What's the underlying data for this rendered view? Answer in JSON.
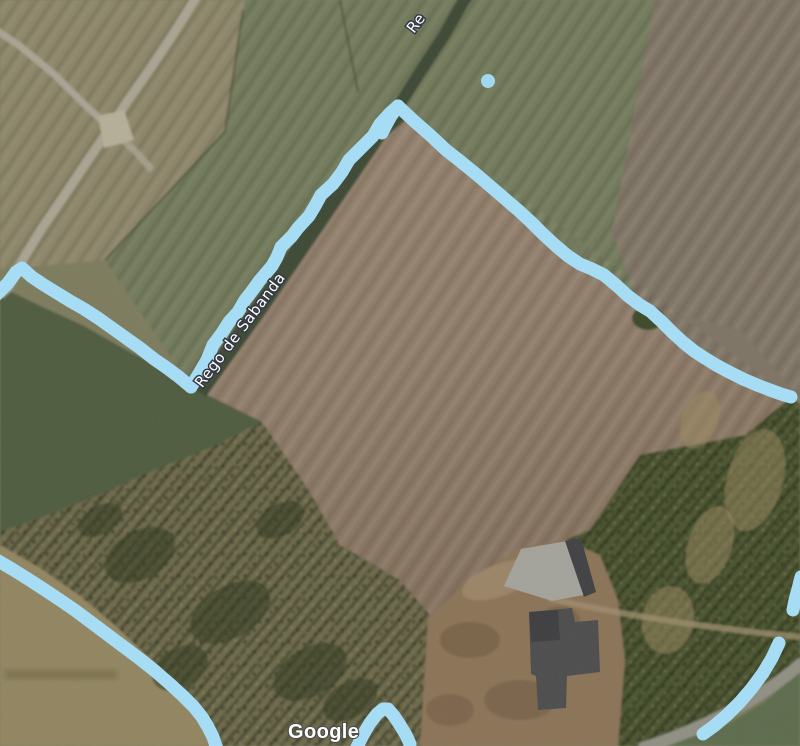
{
  "map": {
    "watermark": "Google",
    "labels": {
      "stream": "Rego de Sabanda",
      "stream_partial": "Re"
    },
    "annotation": {
      "stroke_color": "#a6dcf4",
      "stroke_width": 13,
      "dot_color": "#a0d8f0"
    },
    "terrain_colors": {
      "plowed_field": "#8d7a68",
      "green_field": "#71785a",
      "dark_green_field": "#4d5a3e",
      "cornfield": "#6c6849",
      "tan_field": "#8c8468",
      "road": "#a9a391",
      "building_roof_dark": "#4b4b4b",
      "building_roof_light": "#a3a29a"
    }
  }
}
